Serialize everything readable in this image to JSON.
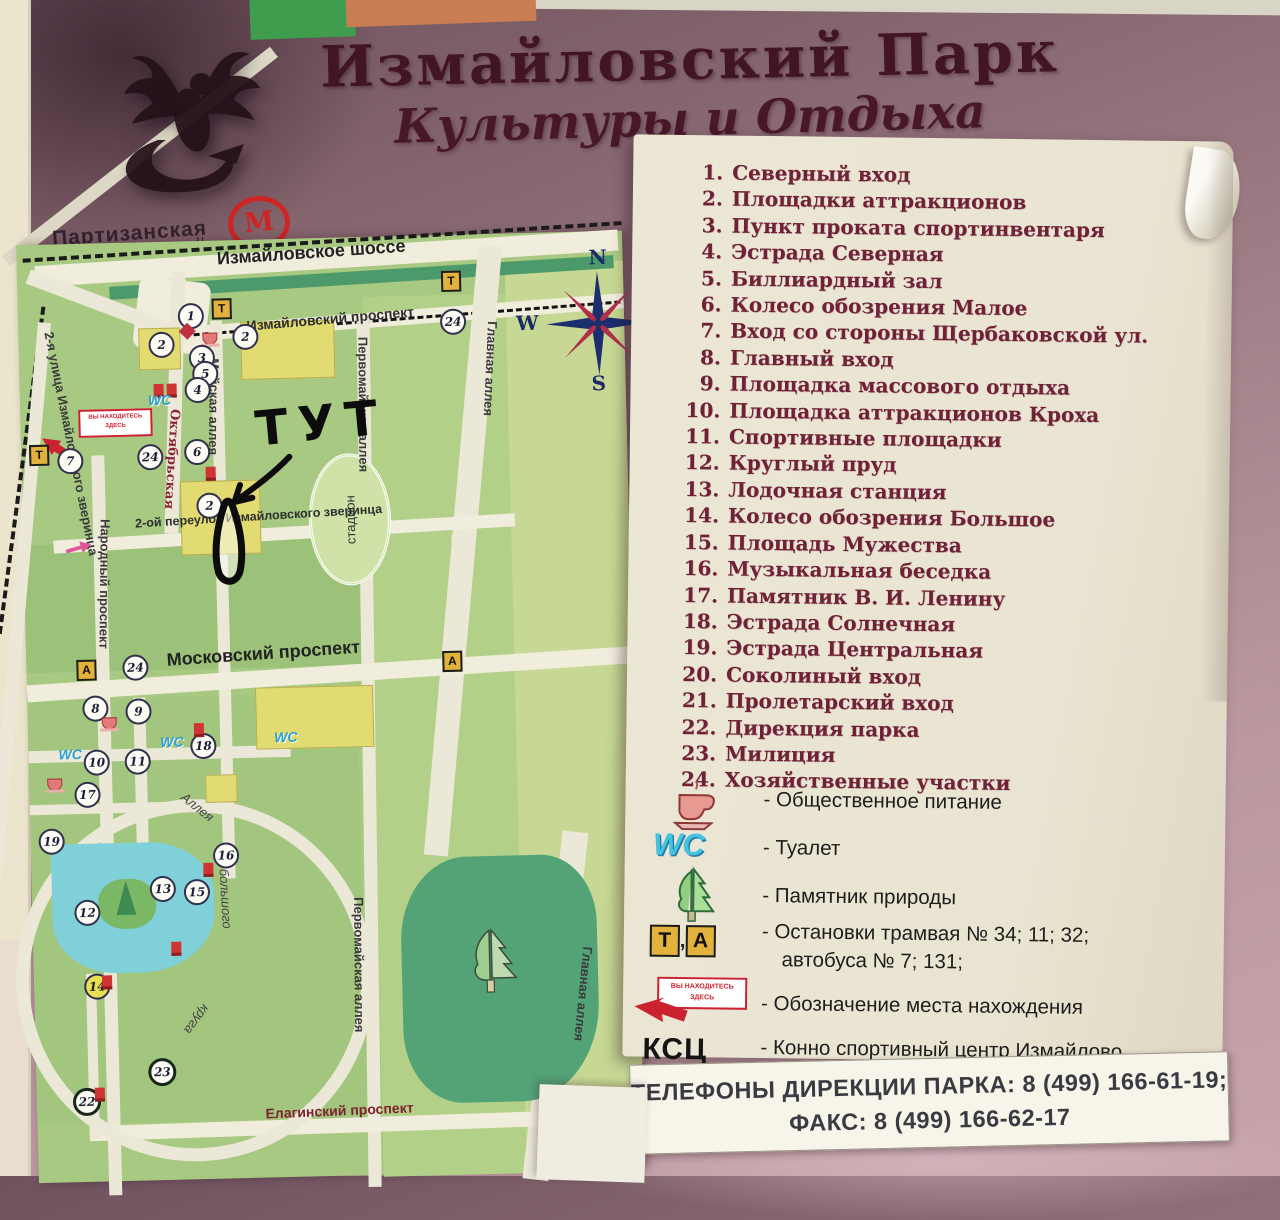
{
  "board": {
    "title_line1": "Измайловский Парк",
    "title_line2": "Культуры и Отдыха",
    "metro": {
      "symbol": "М",
      "station": "Партизанская",
      "tick": "ц"
    }
  },
  "map": {
    "annotation": "ТУТ",
    "stadium_label": "стадион",
    "compass": {
      "n": "N",
      "e": "E",
      "s": "S",
      "w": "W"
    },
    "street_labels": [
      {
        "t": "Измайловское шоссе",
        "x": 200,
        "y": 8,
        "r": -2.5,
        "cls": "lg"
      },
      {
        "t": "Измайловский проспект",
        "x": 228,
        "y": 78,
        "r": -3.5,
        "cls": "md"
      },
      {
        "t": "Главная аллея",
        "x": 482,
        "y": 88,
        "r": 94,
        "cls": "vert"
      },
      {
        "t": "Главная аллея",
        "x": 562,
        "y": 716,
        "r": 97,
        "cls": "vert"
      },
      {
        "t": "Первомайская аллея",
        "x": 352,
        "y": 100,
        "r": 91,
        "cls": "vert"
      },
      {
        "t": "Первомайская аллея",
        "x": 334,
        "y": 660,
        "r": 91,
        "cls": "vert"
      },
      {
        "t": "Майская аллея",
        "x": 203,
        "y": 118,
        "r": 92,
        "cls": "vert"
      },
      {
        "t": "Октябрьская",
        "x": 162,
        "y": 168,
        "r": 95,
        "cls": "vert okt"
      },
      {
        "t": "Народный проспект",
        "x": 90,
        "y": 276,
        "r": 92,
        "cls": "vert"
      },
      {
        "t": "2-я улица Измайловского зверинца",
        "x": 38,
        "y": 86,
        "r": 80,
        "cls": "vert"
      },
      {
        "t": "2-ой переулок Измайловского зверинца",
        "x": 112,
        "y": 274,
        "r": -2,
        "cls": "sm"
      },
      {
        "t": "Московский проспект",
        "x": 140,
        "y": 408,
        "r": -2.5,
        "cls": "lg"
      },
      {
        "t": "Елагинский проспект",
        "x": 228,
        "y": 866,
        "r": -1,
        "cls": "md dark-red"
      },
      {
        "t": "Аллея",
        "x": 158,
        "y": 548,
        "r": 40,
        "cls": "ring-l"
      },
      {
        "t": "большого",
        "x": 200,
        "y": 628,
        "r": 88,
        "cls": "ring-l"
      },
      {
        "t": "круга",
        "x": 178,
        "y": 770,
        "r": 128,
        "cls": "ring-l"
      }
    ],
    "markers": [
      {
        "type": "c",
        "n": "1",
        "x": 160,
        "y": 62
      },
      {
        "type": "dia",
        "x": 163,
        "y": 84
      },
      {
        "type": "box",
        "n": "Т",
        "x": 194,
        "y": 58
      },
      {
        "type": "box",
        "n": "Т",
        "x": 424,
        "y": 36
      },
      {
        "type": "c",
        "n": "24",
        "x": 422,
        "y": 74
      },
      {
        "type": "c",
        "n": "2",
        "x": 130,
        "y": 90
      },
      {
        "type": "c",
        "n": "2",
        "x": 214,
        "y": 84
      },
      {
        "type": "cup",
        "x": 184,
        "y": 92
      },
      {
        "type": "c",
        "n": "3",
        "x": 170,
        "y": 104
      },
      {
        "type": "c",
        "n": "5",
        "x": 173,
        "y": 120
      },
      {
        "type": "c",
        "n": "4",
        "x": 165,
        "y": 136
      },
      {
        "type": "red",
        "x": 134,
        "y": 142
      },
      {
        "type": "red",
        "x": 147,
        "y": 142
      },
      {
        "type": "wc",
        "n": "WC",
        "x": 128,
        "y": 150
      },
      {
        "type": "youbox",
        "n": "ВЫ НАХОДИТЕСЬ ЗДЕСЬ",
        "x": 58,
        "y": 166
      },
      {
        "type": "youarrow",
        "x": 18,
        "y": 196,
        "r": 35
      },
      {
        "type": "c",
        "n": "7",
        "x": 36,
        "y": 204
      },
      {
        "type": "box",
        "n": "Т",
        "x": 8,
        "y": 200
      },
      {
        "type": "c",
        "n": "24",
        "x": 116,
        "y": 202
      },
      {
        "type": "c",
        "n": "6",
        "x": 163,
        "y": 198
      },
      {
        "type": "red",
        "x": 184,
        "y": 226
      },
      {
        "type": "c",
        "n": "2",
        "x": 174,
        "y": 252
      },
      {
        "type": "pink",
        "x": 42,
        "y": 298,
        "r": -15
      },
      {
        "type": "box",
        "n": "А",
        "x": 50,
        "y": 416
      },
      {
        "type": "c",
        "n": "24",
        "x": 96,
        "y": 412
      },
      {
        "type": "box",
        "n": "А",
        "x": 416,
        "y": 416
      },
      {
        "type": "c",
        "n": "8",
        "x": 55,
        "y": 452
      },
      {
        "type": "c",
        "n": "9",
        "x": 98,
        "y": 456
      },
      {
        "type": "cup",
        "x": 74,
        "y": 474
      },
      {
        "type": "wc",
        "n": "WC",
        "x": 30,
        "y": 502
      },
      {
        "type": "c",
        "n": "10",
        "x": 55,
        "y": 506
      },
      {
        "type": "c",
        "n": "11",
        "x": 96,
        "y": 506
      },
      {
        "type": "wc",
        "n": "WC",
        "x": 132,
        "y": 492
      },
      {
        "type": "c",
        "n": "18",
        "x": 162,
        "y": 492
      },
      {
        "type": "red",
        "x": 166,
        "y": 482
      },
      {
        "type": "wc",
        "n": "WC",
        "x": 246,
        "y": 490
      },
      {
        "type": "cup",
        "x": 18,
        "y": 534
      },
      {
        "type": "c",
        "n": "17",
        "x": 45,
        "y": 538
      },
      {
        "type": "c",
        "n": "19",
        "x": 8,
        "y": 584
      },
      {
        "type": "c",
        "n": "16",
        "x": 182,
        "y": 602
      },
      {
        "type": "red",
        "x": 172,
        "y": 622
      },
      {
        "type": "c",
        "n": "13",
        "x": 118,
        "y": 634
      },
      {
        "type": "c",
        "n": "15",
        "x": 152,
        "y": 638
      },
      {
        "type": "c",
        "n": "12",
        "x": 42,
        "y": 656
      },
      {
        "type": "red",
        "x": 138,
        "y": 700
      },
      {
        "type": "c",
        "n": "14",
        "x": 50,
        "y": 730,
        "cls": "yellow"
      },
      {
        "type": "red",
        "x": 68,
        "y": 732
      },
      {
        "type": "c",
        "n": "23",
        "x": 112,
        "y": 816,
        "cls": "dark"
      },
      {
        "type": "c",
        "n": "22",
        "x": 36,
        "y": 844,
        "cls": "dark"
      },
      {
        "type": "red",
        "x": 58,
        "y": 844
      }
    ]
  },
  "legend": {
    "items": [
      {
        "n": "1.",
        "t": "Северный вход"
      },
      {
        "n": "2.",
        "t": "Площадки аттракционов"
      },
      {
        "n": "3.",
        "t": "Пункт проката спортинвентаря"
      },
      {
        "n": "4.",
        "t": "Эстрада Северная"
      },
      {
        "n": "5.",
        "t": "Биллиардный зал"
      },
      {
        "n": "6.",
        "t": "Колесо обозрения Малое"
      },
      {
        "n": "7.",
        "t": "Вход со стороны Щербаковской ул."
      },
      {
        "n": "8.",
        "t": "Главный вход"
      },
      {
        "n": "9.",
        "t": "Площадка массового отдыха"
      },
      {
        "n": "10.",
        "t": "Площадка аттракционов Кроха"
      },
      {
        "n": "11.",
        "t": "Спортивные площадки"
      },
      {
        "n": "12.",
        "t": "Круглый пруд"
      },
      {
        "n": "13.",
        "t": "Лодочная станция"
      },
      {
        "n": "14.",
        "t": "Колесо обозрения Большое"
      },
      {
        "n": "15.",
        "t": "Площадь Мужества"
      },
      {
        "n": "16.",
        "t": "Музыкальная беседка"
      },
      {
        "n": "17.",
        "t": "Памятник В. И. Ленину"
      },
      {
        "n": "18.",
        "t": "Эстрада Солнечная"
      },
      {
        "n": "19.",
        "t": "Эстрада Центральная"
      },
      {
        "n": "20.",
        "t": "Соколиный вход"
      },
      {
        "n": "21.",
        "t": "Пролетарский вход"
      },
      {
        "n": "22.",
        "t": "Дирекция парка"
      },
      {
        "n": "23.",
        "t": "Милиция"
      },
      {
        "n": "24.",
        "t": "Хозяйственные участки"
      }
    ],
    "symbols": {
      "food_label": "- Общественное питание",
      "wc_text": "WC",
      "wc_label": "- Туалет",
      "tree_label": "- Памятник природы",
      "transit_t": "Т",
      "transit_comma": ",",
      "transit_a": "А",
      "transit_label1": "- Остановки трамвая № 34; 11; 32;",
      "transit_label2": "автобуса № 7; 131;",
      "youarehere_box": "ВЫ НАХОДИТЕСЬ ЗДЕСЬ",
      "youarehere_label": "- Обозначение места нахождения",
      "ksc_text": "КСЦ",
      "ksc_label": "- Конно спортивный центр Измайлово",
      "ksc_sub": "тел. 109-90-88 факс 176-78-35"
    },
    "phones_line1": "ТЕЛЕФОНЫ ДИРЕКЦИИ ПАРКА: 8 (499) 166-61-19;",
    "phones_line2": "ФАКС:  8 (499) 166-62-17"
  }
}
